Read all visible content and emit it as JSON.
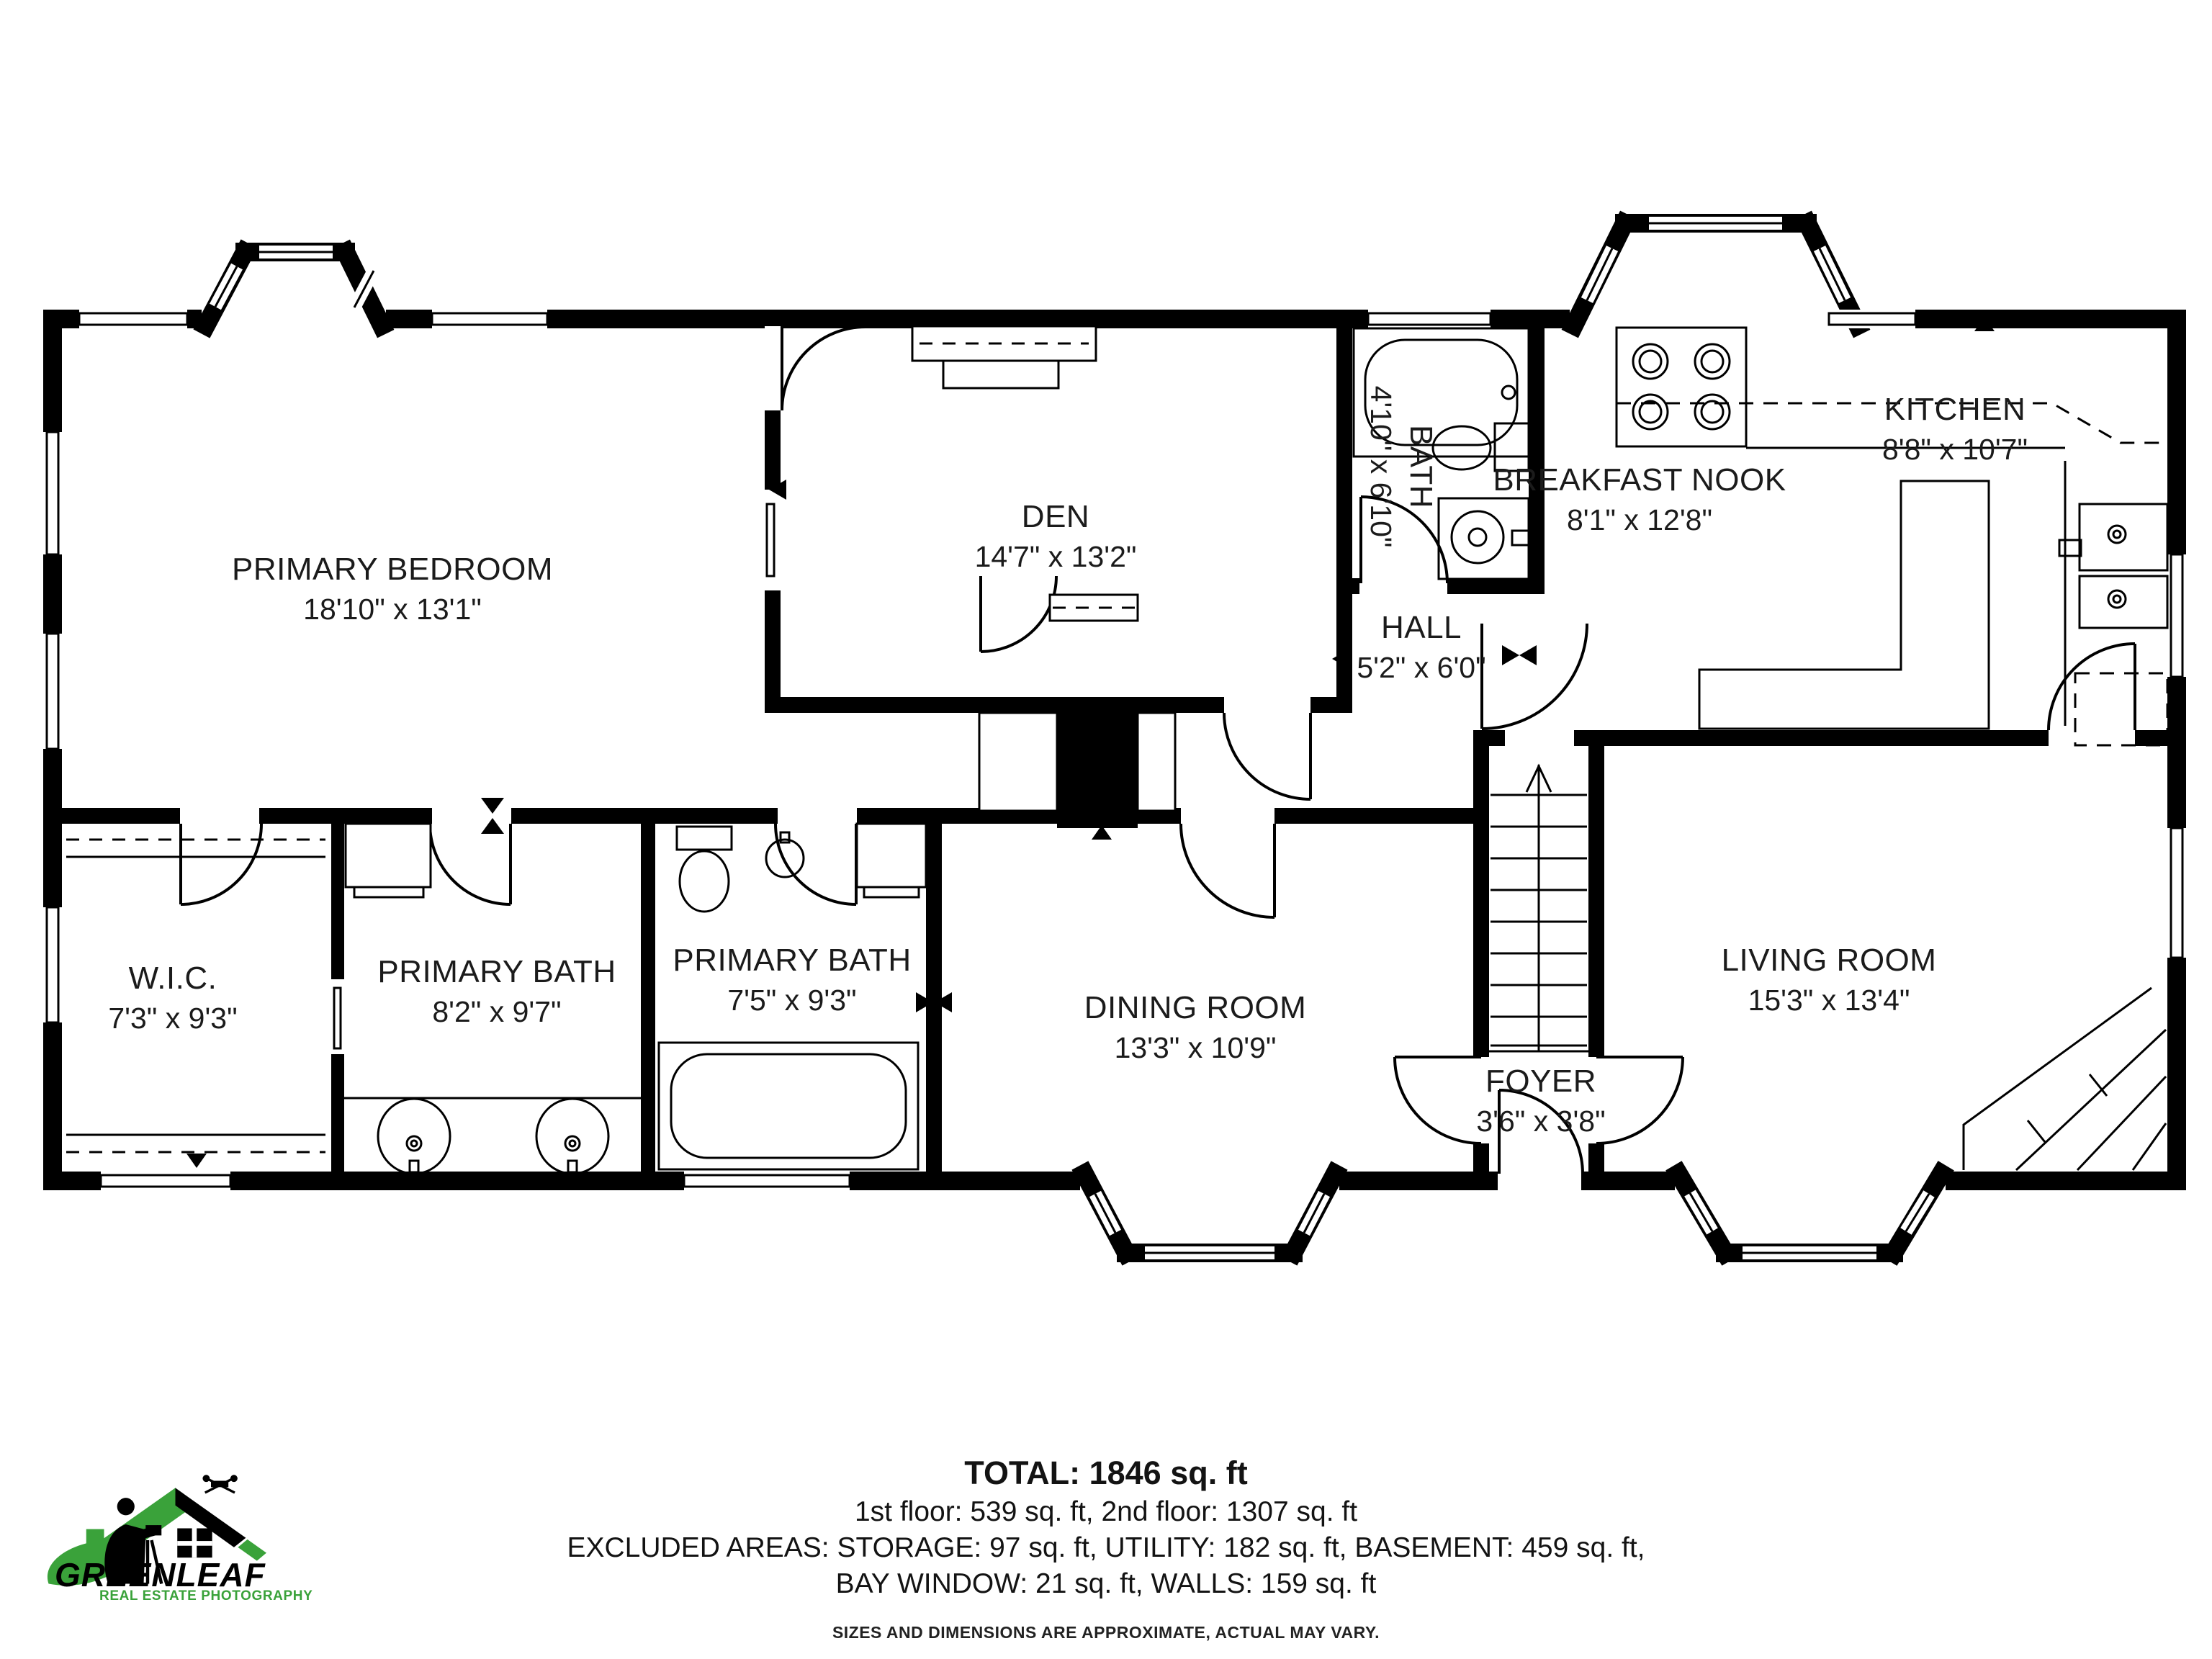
{
  "rooms": [
    {
      "name": "PRIMARY BEDROOM",
      "dims": "18'10\" x 13'1\""
    },
    {
      "name": "DEN",
      "dims": "14'7\" x 13'2\""
    },
    {
      "name": "BATH",
      "dims": "4'10\" x 6'10\""
    },
    {
      "name": "BREAKFAST NOOK",
      "dims": "8'1\" x 12'8\""
    },
    {
      "name": "KITCHEN",
      "dims": "8'8\" x 10'7\""
    },
    {
      "name": "HALL",
      "dims": "5'2\" x 6'0\""
    },
    {
      "name": "W.I.C.",
      "dims": "7'3\" x 9'3\""
    },
    {
      "name": "PRIMARY BATH",
      "dims": "8'2\" x 9'7\""
    },
    {
      "name": "PRIMARY BATH",
      "dims": "7'5\" x 9'3\""
    },
    {
      "name": "DINING ROOM",
      "dims": "13'3\" x 10'9\""
    },
    {
      "name": "FOYER",
      "dims": "3'6\" x 3'8\""
    },
    {
      "name": "LIVING ROOM",
      "dims": "15'3\" x 13'4\""
    }
  ],
  "summary": {
    "total": "TOTAL: 1846 sq. ft",
    "floors": "1st floor: 539 sq. ft, 2nd floor: 1307 sq. ft",
    "excluded1": "EXCLUDED AREAS: STORAGE: 97 sq. ft, UTILITY: 182 sq. ft, BASEMENT: 459 sq. ft,",
    "excluded2": "BAY WINDOW: 21 sq. ft, WALLS: 159 sq. ft",
    "disclaimer": "SIZES AND DIMENSIONS ARE APPROXIMATE, ACTUAL MAY VARY."
  },
  "logo": {
    "brand": "GREENLEAF",
    "tagline": "REAL ESTATE PHOTOGRAPHY",
    "green": "#3aa23a"
  },
  "colors": {
    "wall": "#000000",
    "text": "#1b1b1b"
  }
}
